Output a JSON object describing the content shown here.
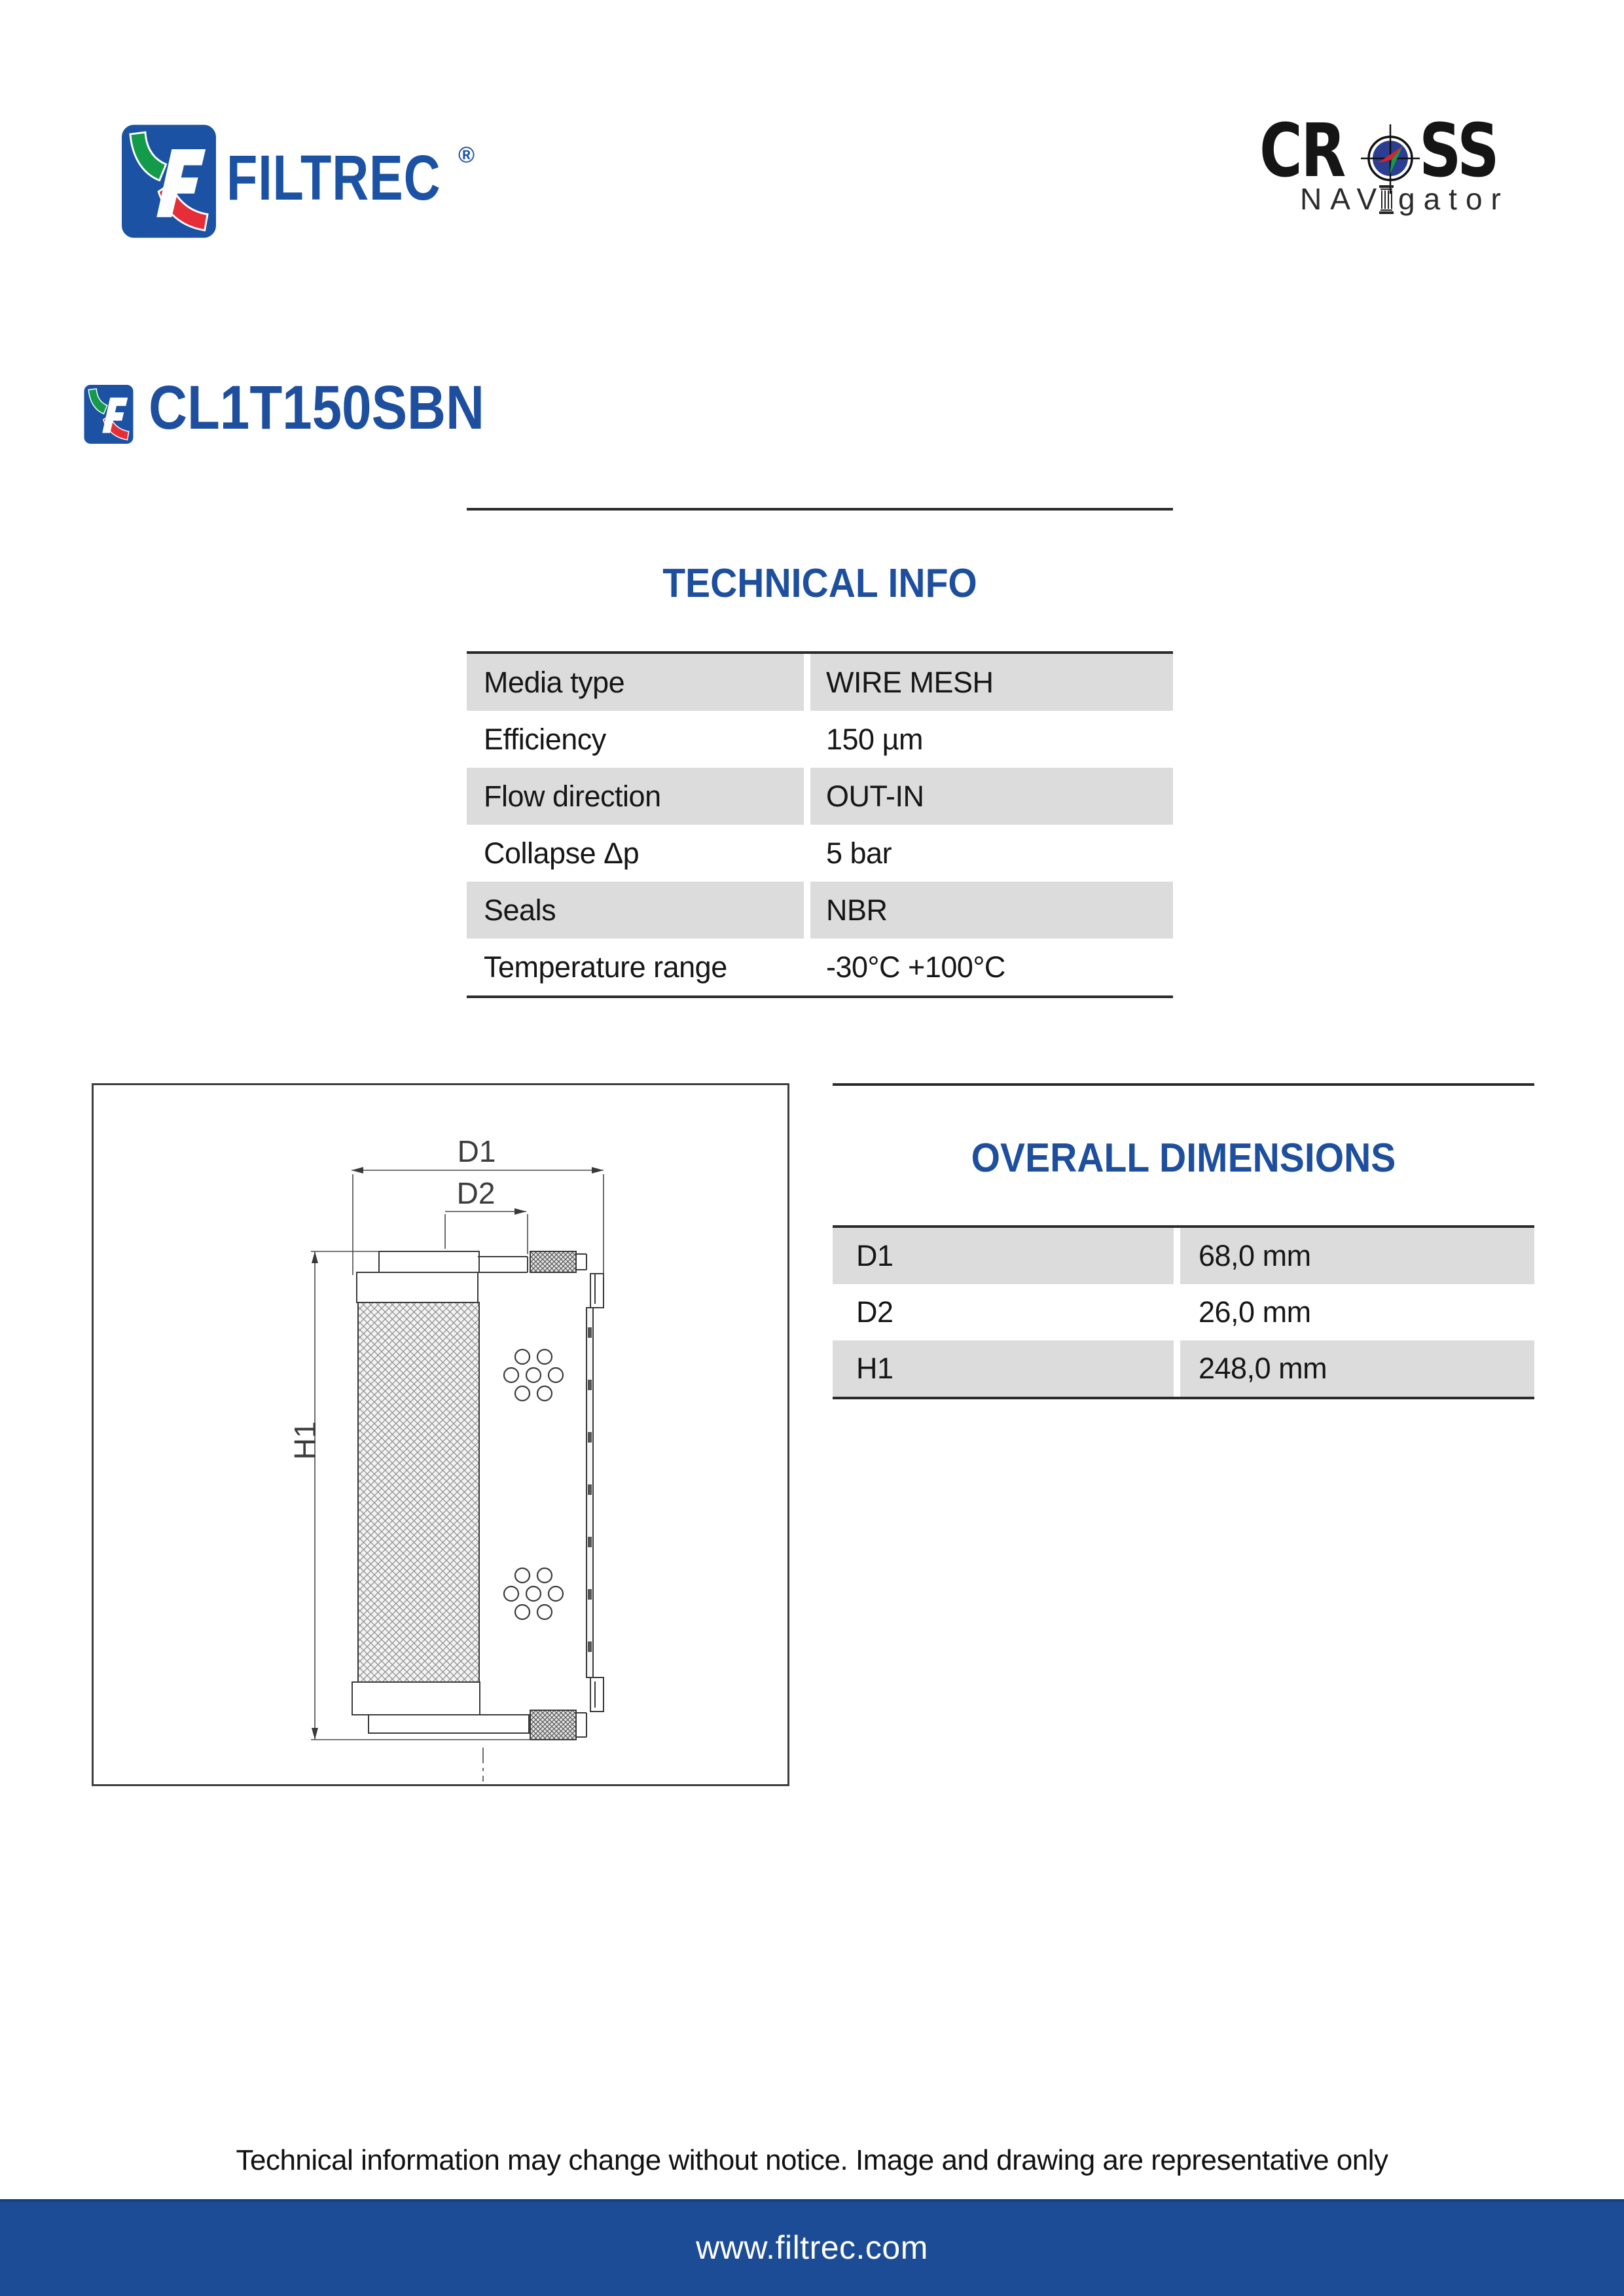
{
  "header": {
    "filtrec_logo": {
      "wordmark": "FILTREC",
      "registered_mark": "®"
    },
    "cross_logo": {
      "cross_left": "CR",
      "cross_right": "SS",
      "nav": "NAV",
      "gator": "gator"
    }
  },
  "part": {
    "number": "CL1T150SBN"
  },
  "technical_info": {
    "title": "TECHNICAL INFO",
    "rows": [
      {
        "label": "Media type",
        "value": "WIRE MESH"
      },
      {
        "label": "Efficiency",
        "value": "150 µm"
      },
      {
        "label": "Flow direction",
        "value": "OUT-IN"
      },
      {
        "label": "Collapse Δp",
        "value": "5 bar"
      },
      {
        "label": "Seals",
        "value": "NBR"
      },
      {
        "label": "Temperature range",
        "value": "-30°C +100°C"
      }
    ]
  },
  "overall_dimensions": {
    "title": "OVERALL DIMENSIONS",
    "rows": [
      {
        "label": "D1",
        "value": "68,0 mm"
      },
      {
        "label": "D2",
        "value": "26,0 mm"
      },
      {
        "label": "H1",
        "value": "248,0 mm"
      }
    ]
  },
  "drawing": {
    "labels": {
      "d1": "D1",
      "d2": "D2",
      "h1": "H1"
    }
  },
  "footer": {
    "disclaimer": "Technical information may change without notice. Image and drawing are representative only",
    "website": "www.filtrec.com"
  },
  "colors": {
    "brand_blue": "#1E4F9E",
    "logo_blue": "#1B52A4",
    "logo_green": "#149B4A",
    "logo_red": "#E62E39",
    "table_gray": "#DCDCDC",
    "footer_bar_blue": "#1D4C96"
  }
}
